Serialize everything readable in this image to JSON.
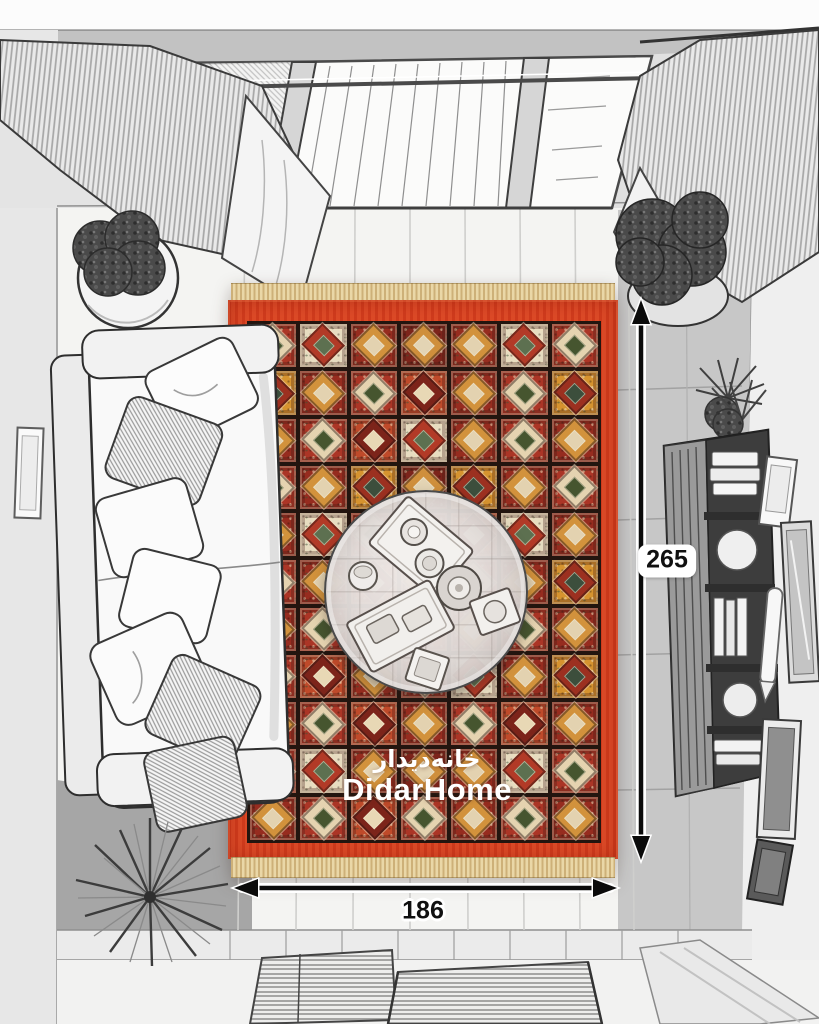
{
  "watermark": {
    "fa": "خانه‌دیدار",
    "en": "DidarHome"
  },
  "dimensions": {
    "height": "265",
    "width": "186"
  },
  "theme": {
    "rug_border": "#d8401f",
    "rug_grid": "#23150f",
    "fringe_a": "#cdb078",
    "fringe_b": "#ead7a7",
    "arrow": "#0b0b0b",
    "label_bg": "#ffffff",
    "label_text": "#101010",
    "watermark": "#ffffff"
  },
  "rug": {
    "rows": 11,
    "cols": 7,
    "palette": {
      "r1": {
        "bg": "#ab3526",
        "motif": "#e5d3b0",
        "accent": "#46552f"
      },
      "r2": {
        "bg": "#962c1f",
        "motif": "#d2923c",
        "accent": "#e3d2b0"
      },
      "r3": {
        "bg": "#bf4a2a",
        "motif": "#7c241a",
        "accent": "#e8d8b5"
      },
      "dark": {
        "bg": "#7c241b",
        "motif": "#cf8f3c",
        "accent": "#e3d4b4"
      },
      "cream": {
        "bg": "#e7dcc0",
        "motif": "#b23a27",
        "accent": "#5d7050"
      },
      "gold": {
        "bg": "#d6932f",
        "motif": "#9c3020",
        "accent": "#3c4e3c"
      }
    },
    "tiles": [
      [
        "r1",
        "cream",
        "r2",
        "dark",
        "r2",
        "cream",
        "r1"
      ],
      [
        "gold",
        "r2",
        "r1",
        "r3",
        "r2",
        "r1",
        "gold"
      ],
      [
        "r2",
        "r1",
        "r3",
        "cream",
        "r2",
        "r1",
        "r2"
      ],
      [
        "r1",
        "r2",
        "gold",
        "dark",
        "gold",
        "r2",
        "r1"
      ],
      [
        "r2",
        "cream",
        "r1",
        "r2",
        "r3",
        "cream",
        "r2"
      ],
      [
        "r1",
        "r2",
        "r3",
        "dark",
        "r1",
        "r2",
        "gold"
      ],
      [
        "r2",
        "r1",
        "dark",
        "r3",
        "r2",
        "r1",
        "r2"
      ],
      [
        "r1",
        "r3",
        "r2",
        "r1",
        "cream",
        "r2",
        "gold"
      ],
      [
        "r2",
        "r1",
        "r3",
        "r2",
        "r1",
        "r3",
        "r2"
      ],
      [
        "r1",
        "cream",
        "r2",
        "dark",
        "r2",
        "cream",
        "r1"
      ],
      [
        "r2",
        "r1",
        "r3",
        "r1",
        "r2",
        "r1",
        "r2"
      ]
    ]
  }
}
